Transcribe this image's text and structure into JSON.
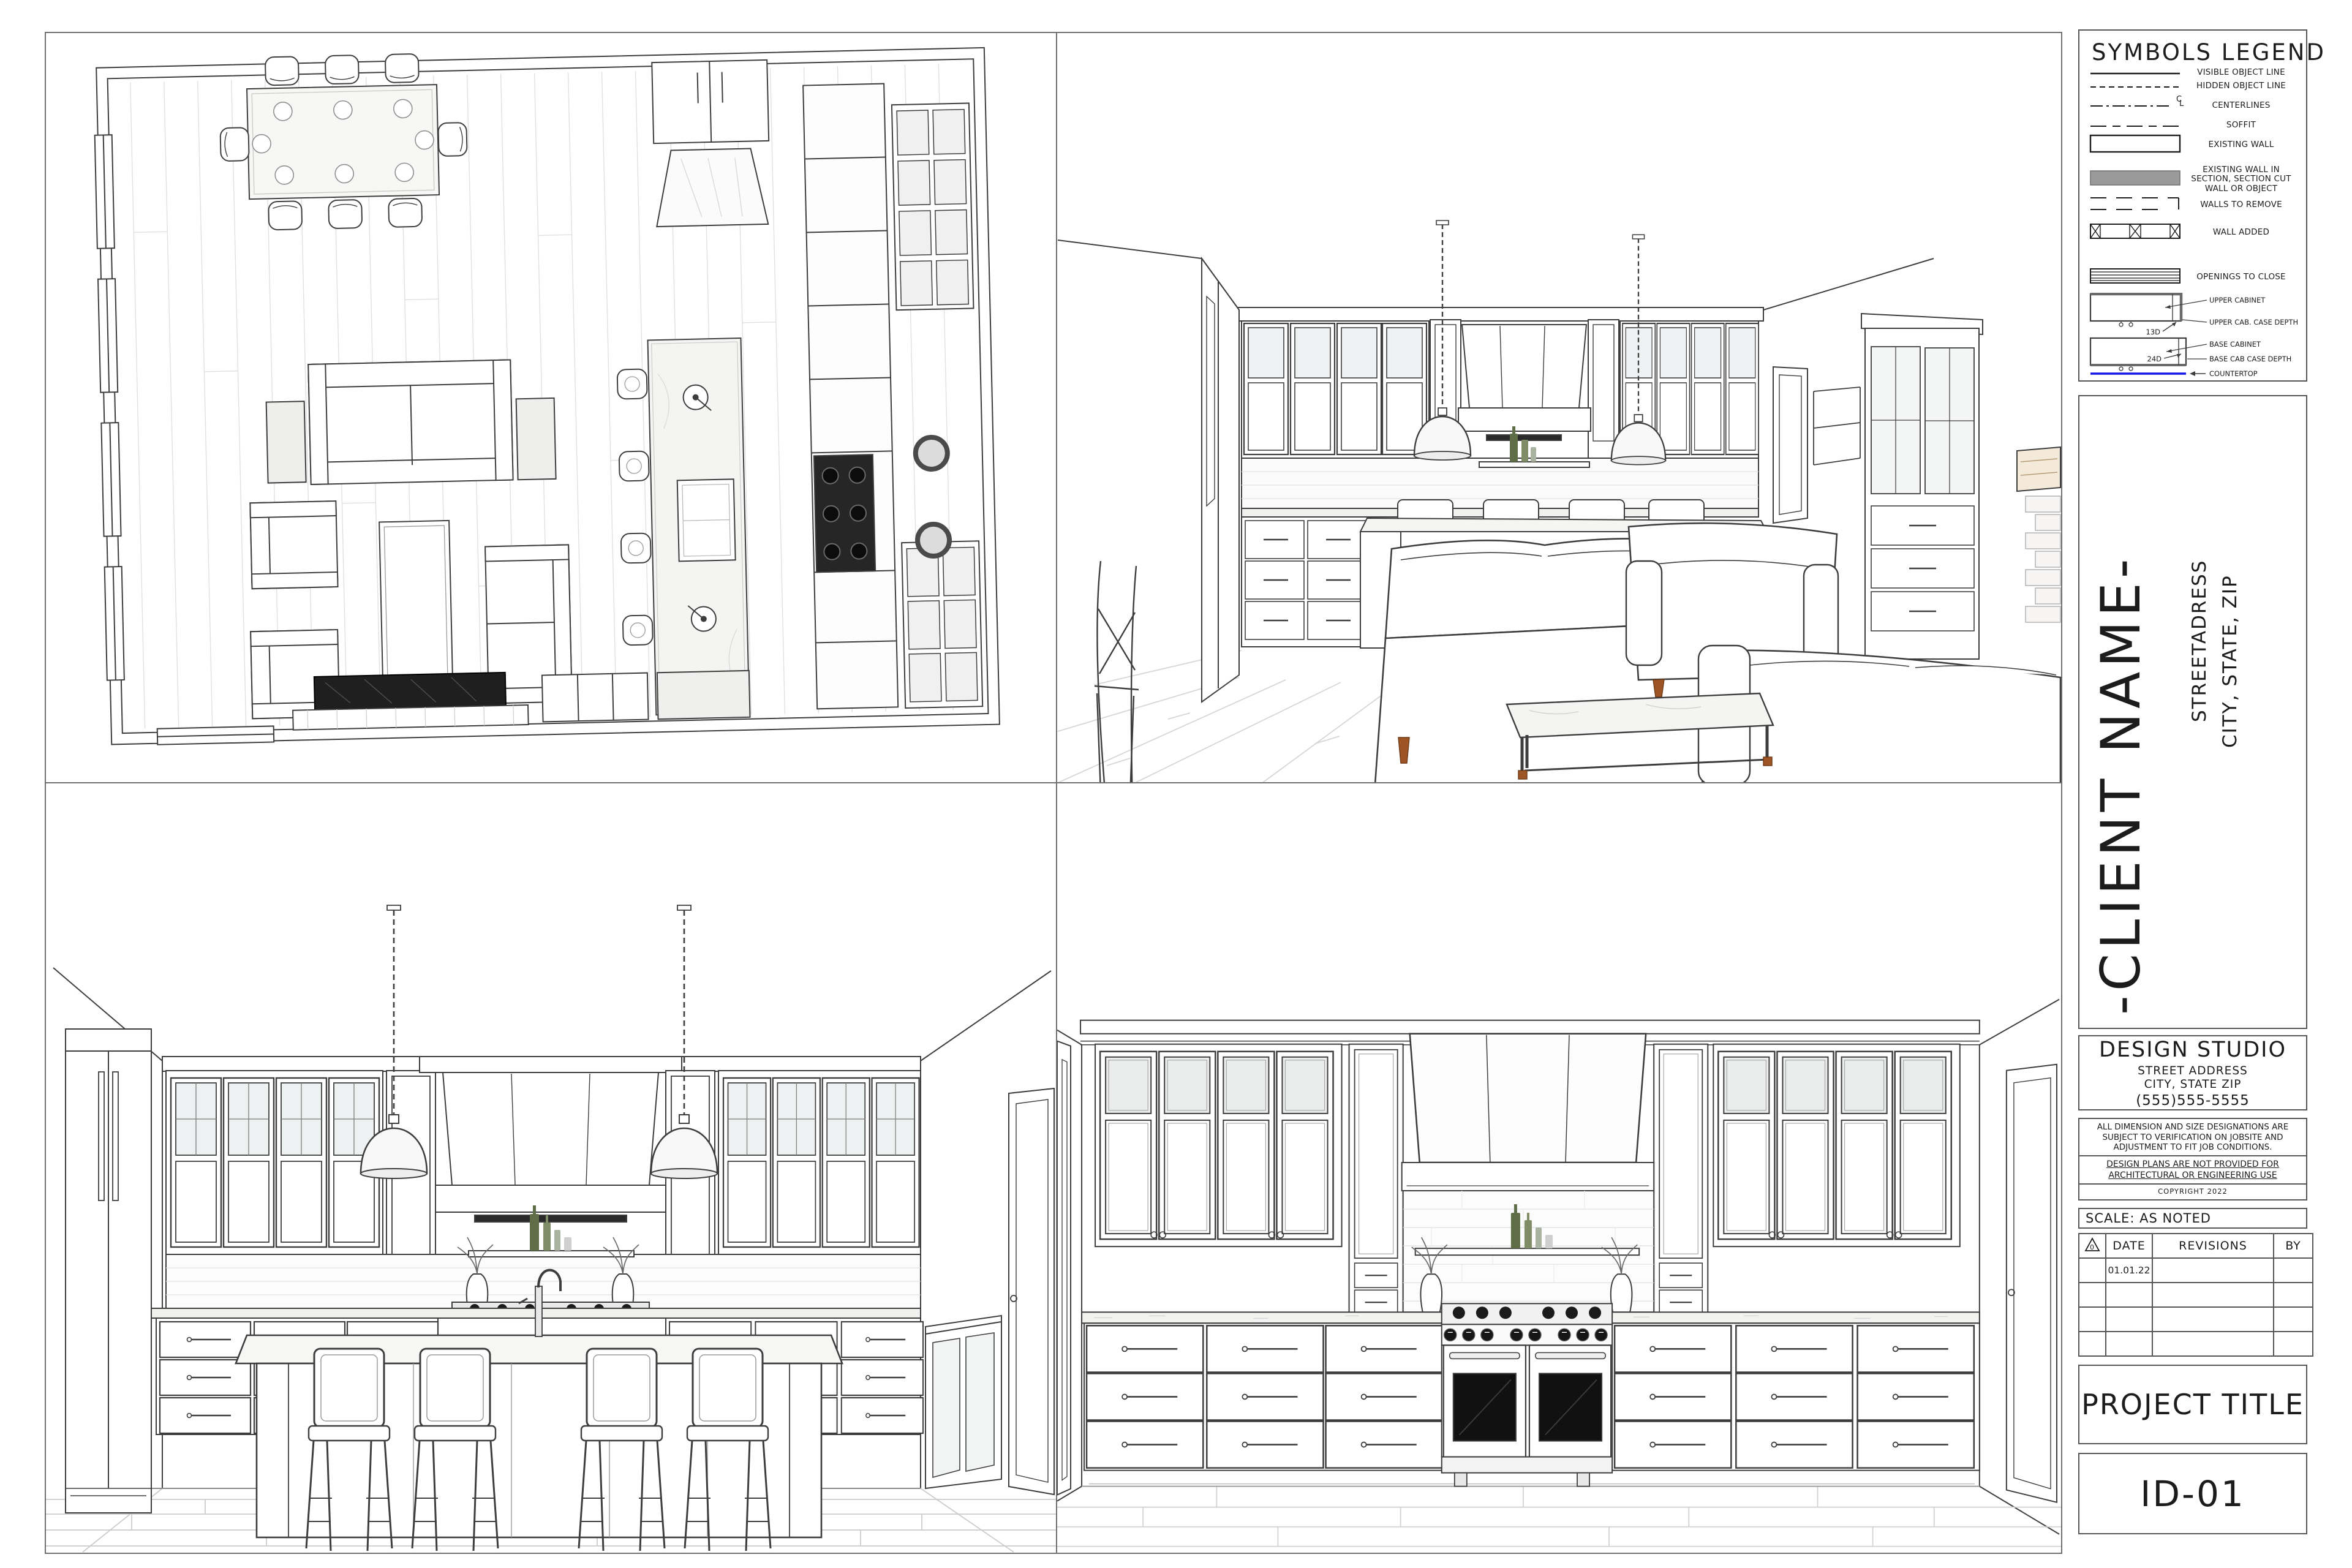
{
  "legend": {
    "title": "SYMBOLS LEGEND",
    "items": [
      {
        "label": "VISIBLE OBJECT LINE"
      },
      {
        "label": "HIDDEN OBJECT LINE"
      },
      {
        "label": "CENTERLINES",
        "glyph_top": "C",
        "glyph_bottom": "L"
      },
      {
        "label": "SOFFIT"
      },
      {
        "label": "EXISTING WALL"
      },
      {
        "label": "EXISTING WALL IN SECTION, SECTION CUT WALL OR OBJECT"
      },
      {
        "label": "WALLS TO REMOVE"
      },
      {
        "label": "WALL ADDED"
      },
      {
        "label": "OPENINGS TO CLOSE"
      }
    ],
    "cabinet_key": {
      "upper_cabinet": "UPPER CABINET",
      "upper_depth": "13D",
      "upper_case_depth": "UPPER CAB. CASE DEPTH",
      "base_cabinet": "BASE CABINET",
      "base_depth": "24D",
      "base_case_depth": "BASE CAB CASE DEPTH",
      "countertop": "COUNTERTOP"
    }
  },
  "titleblock": {
    "client": {
      "name": "-CLIENT NAME-",
      "address1": "STREETADRESS",
      "address2": "CITY, STATE, ZIP"
    },
    "studio": {
      "name": "DESIGN STUDIO",
      "address1": "STREET ADDRESS",
      "address2": "CITY, STATE ZIP",
      "phone": "(555)555-5555"
    },
    "disclaimer": {
      "general": "ALL DIMENSION AND SIZE DESIGNATIONS ARE SUBJECT TO VERIFICATION ON JOBSITE AND ADJUSTMENT TO FIT JOB CONDITIONS.",
      "plans": "DESIGN PLANS ARE NOT PROVIDED FOR ARCHITECTURAL OR ENGINEERING USE",
      "copyright": "COPYRIGHT 2022"
    },
    "scale": "SCALE: AS NOTED",
    "revisions": {
      "delta": "0",
      "headers": {
        "date": "DATE",
        "revisions": "REVISIONS",
        "by": "BY"
      },
      "rows": [
        {
          "date": "01.01.22",
          "revisions": "",
          "by": ""
        },
        {
          "date": "",
          "revisions": "",
          "by": ""
        },
        {
          "date": "",
          "revisions": "",
          "by": ""
        },
        {
          "date": "",
          "revisions": "",
          "by": ""
        }
      ]
    },
    "project_title": "PROJECT TITLE",
    "sheet_id": "ID-01"
  },
  "colors": {
    "line": "#3d3d3d",
    "countertop_symbol": "#1414e6",
    "section_wall_fill": "#9a9a9a",
    "wood_accent": "#9d5526",
    "oven_glass": "#111111"
  }
}
